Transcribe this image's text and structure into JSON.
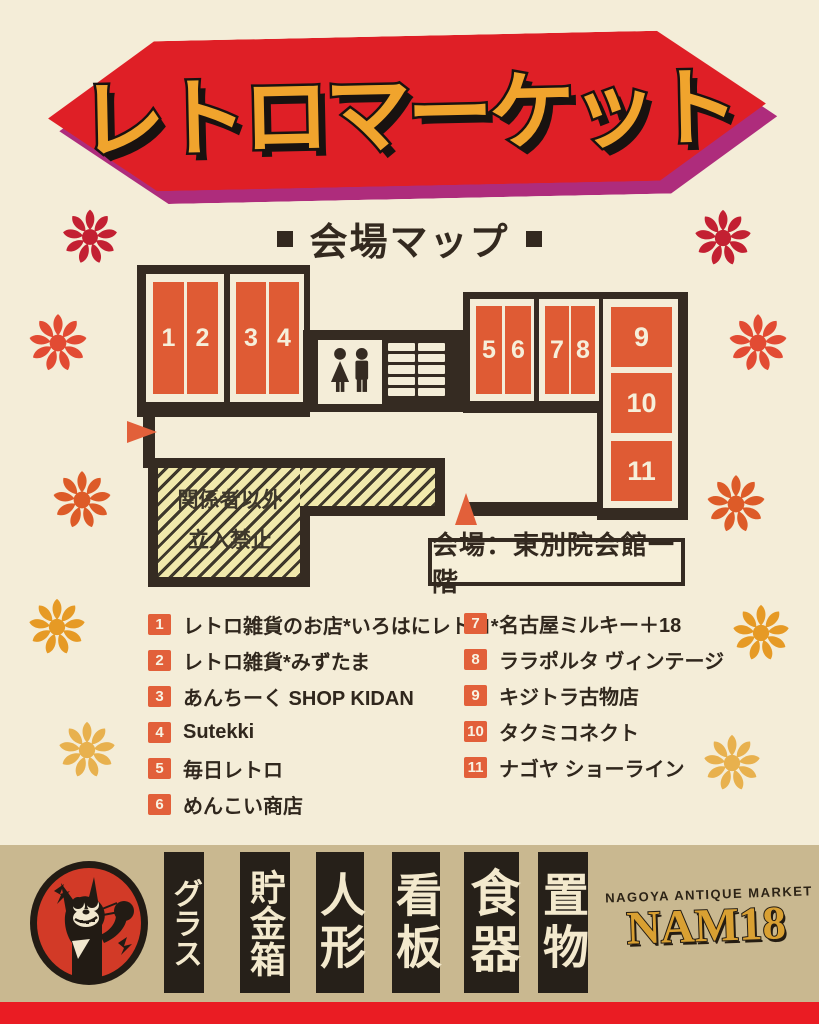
{
  "header": {
    "title": "レトロマーケット"
  },
  "map_heading": {
    "label": "会場マップ"
  },
  "map": {
    "booths": [
      "1",
      "2",
      "3",
      "4",
      "5",
      "6",
      "7",
      "8",
      "9",
      "10",
      "11"
    ],
    "restricted_area": {
      "line1": "関係者以外",
      "line2": "立入禁止"
    },
    "venue_label": "会場：東別院会館一階"
  },
  "legend": {
    "left": [
      {
        "num": "1",
        "label": "レトロ雑貨のお店*いろはにレトロ*"
      },
      {
        "num": "2",
        "label": "レトロ雑貨*みずたま"
      },
      {
        "num": "3",
        "label": "あんちーく SHOP KIDAN"
      },
      {
        "num": "4",
        "label": "Sutekki"
      },
      {
        "num": "5",
        "label": "毎日レトロ"
      },
      {
        "num": "6",
        "label": "めんこい商店"
      }
    ],
    "right": [
      {
        "num": "7",
        "label": "名古屋ミルキー＋18"
      },
      {
        "num": "8",
        "label": "ララポルタ ヴィンテージ"
      },
      {
        "num": "9",
        "label": "キジトラ古物店"
      },
      {
        "num": "10",
        "label": "タクミコネクト"
      },
      {
        "num": "11",
        "label": "ナゴヤ ショーライン"
      }
    ]
  },
  "footer": {
    "signs": [
      "グラス",
      "貯金箱",
      "人形",
      "看板",
      "食器",
      "置物"
    ],
    "brand_small": "NAGOYA ANTIQUE MARKET",
    "brand_large": "NAM18"
  },
  "decorations": {
    "colors": {
      "banner_red": "#df1f26",
      "banner_magenta": "#ae2c7c",
      "title_yellow": "#f0a42d",
      "booth_orange": "#df5b34",
      "wall_dark": "#352b22",
      "paper_cream": "#f4edd8",
      "hatch_yellow": "#f1e9ac",
      "band_tan": "#c9b890",
      "sign_black": "#262019",
      "brand_gold": "#d9a032",
      "strip_red": "#ea1c23",
      "cat_circle_red": "#d23a27"
    },
    "flowers": [
      {
        "x": 90,
        "y": 237,
        "s": 72,
        "c": "#c32032"
      },
      {
        "x": 58,
        "y": 343,
        "s": 76,
        "c": "#e24b33"
      },
      {
        "x": 82,
        "y": 500,
        "s": 76,
        "c": "#dd5b28"
      },
      {
        "x": 57,
        "y": 627,
        "s": 74,
        "c": "#e69a25"
      },
      {
        "x": 87,
        "y": 750,
        "s": 74,
        "c": "#e8b14e"
      },
      {
        "x": 723,
        "y": 238,
        "s": 74,
        "c": "#c32032"
      },
      {
        "x": 758,
        "y": 343,
        "s": 76,
        "c": "#e24b33"
      },
      {
        "x": 736,
        "y": 504,
        "s": 76,
        "c": "#dd5b28"
      },
      {
        "x": 761,
        "y": 633,
        "s": 74,
        "c": "#e69a25"
      },
      {
        "x": 732,
        "y": 763,
        "s": 74,
        "c": "#e8b14e"
      }
    ]
  }
}
